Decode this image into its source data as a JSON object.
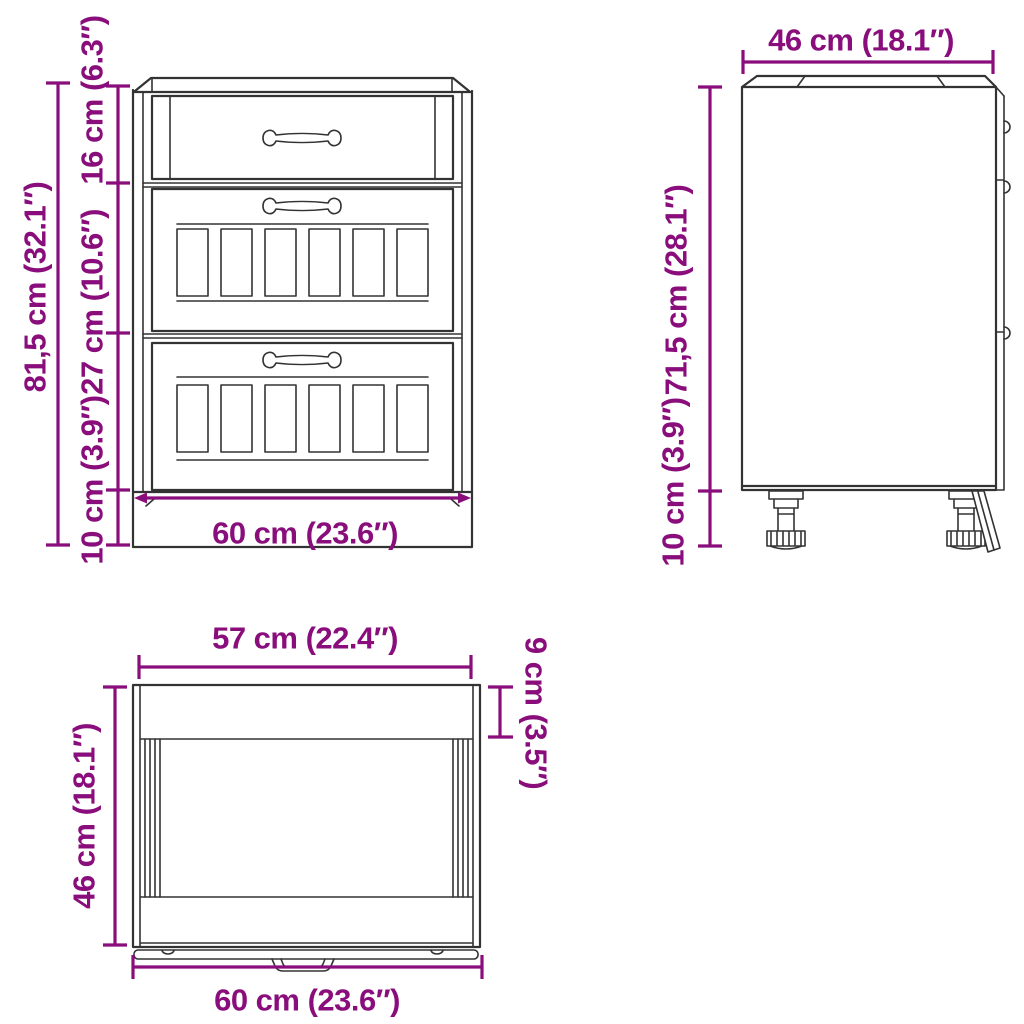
{
  "colors": {
    "dimension": "#8A0D7C",
    "line": "#333333",
    "background": "#FFFFFF"
  },
  "front_view": {
    "dim_total_height": "81,5 cm (32.1″)",
    "dim_top_drawer_height": "16 cm (6.3″)",
    "dim_middle_drawer_height": "27 cm (10.6″)",
    "dim_plinth_height": "10 cm (3.9″)",
    "dim_width": "60 cm (23.6″)"
  },
  "side_view": {
    "dim_depth": "46 cm (18.1″)",
    "dim_body_height": "71,5 cm (28.1″)",
    "dim_feet_height": "10 cm (3.9″)"
  },
  "top_view": {
    "dim_inner_width": "57 cm (22.4″)",
    "dim_front_depth": "9 cm (3.5″)",
    "dim_depth": "46 cm (18.1″)",
    "dim_width": "60 cm (23.6″)"
  }
}
